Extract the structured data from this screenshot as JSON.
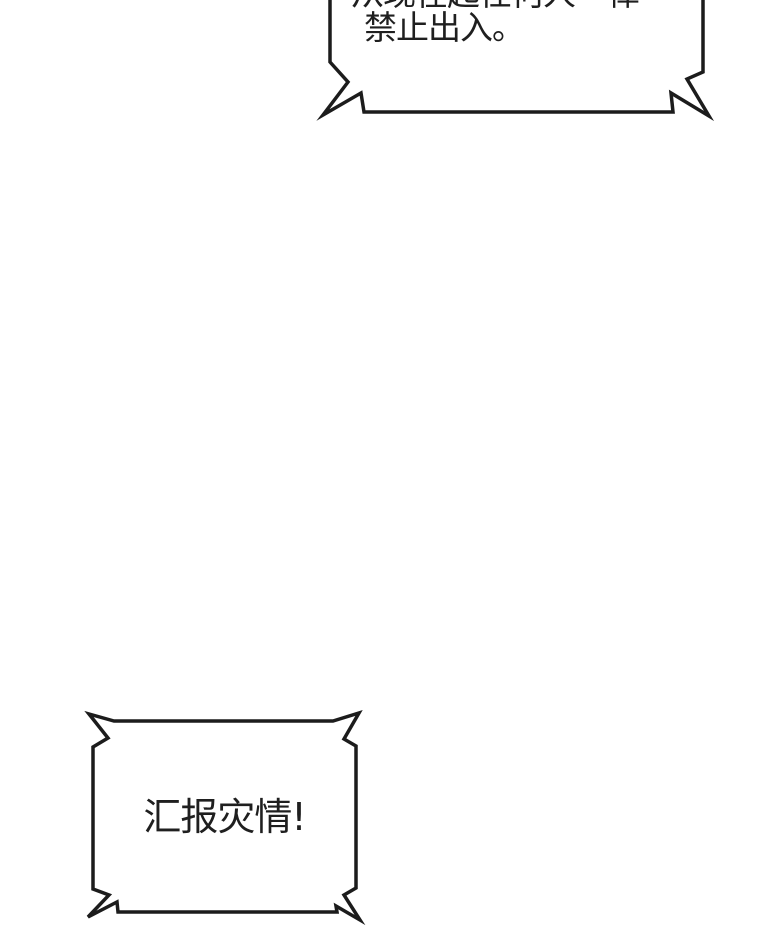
{
  "page": {
    "background": "#ffffff",
    "ink": "#1c1c1c"
  },
  "bubbles": {
    "top": {
      "type": "shout-bubble-clipped-at-top",
      "line1": "从现在起任何人一律",
      "line2": "禁止出入。"
    },
    "bottom": {
      "type": "shout-bubble",
      "text": "汇报灾情!"
    }
  }
}
